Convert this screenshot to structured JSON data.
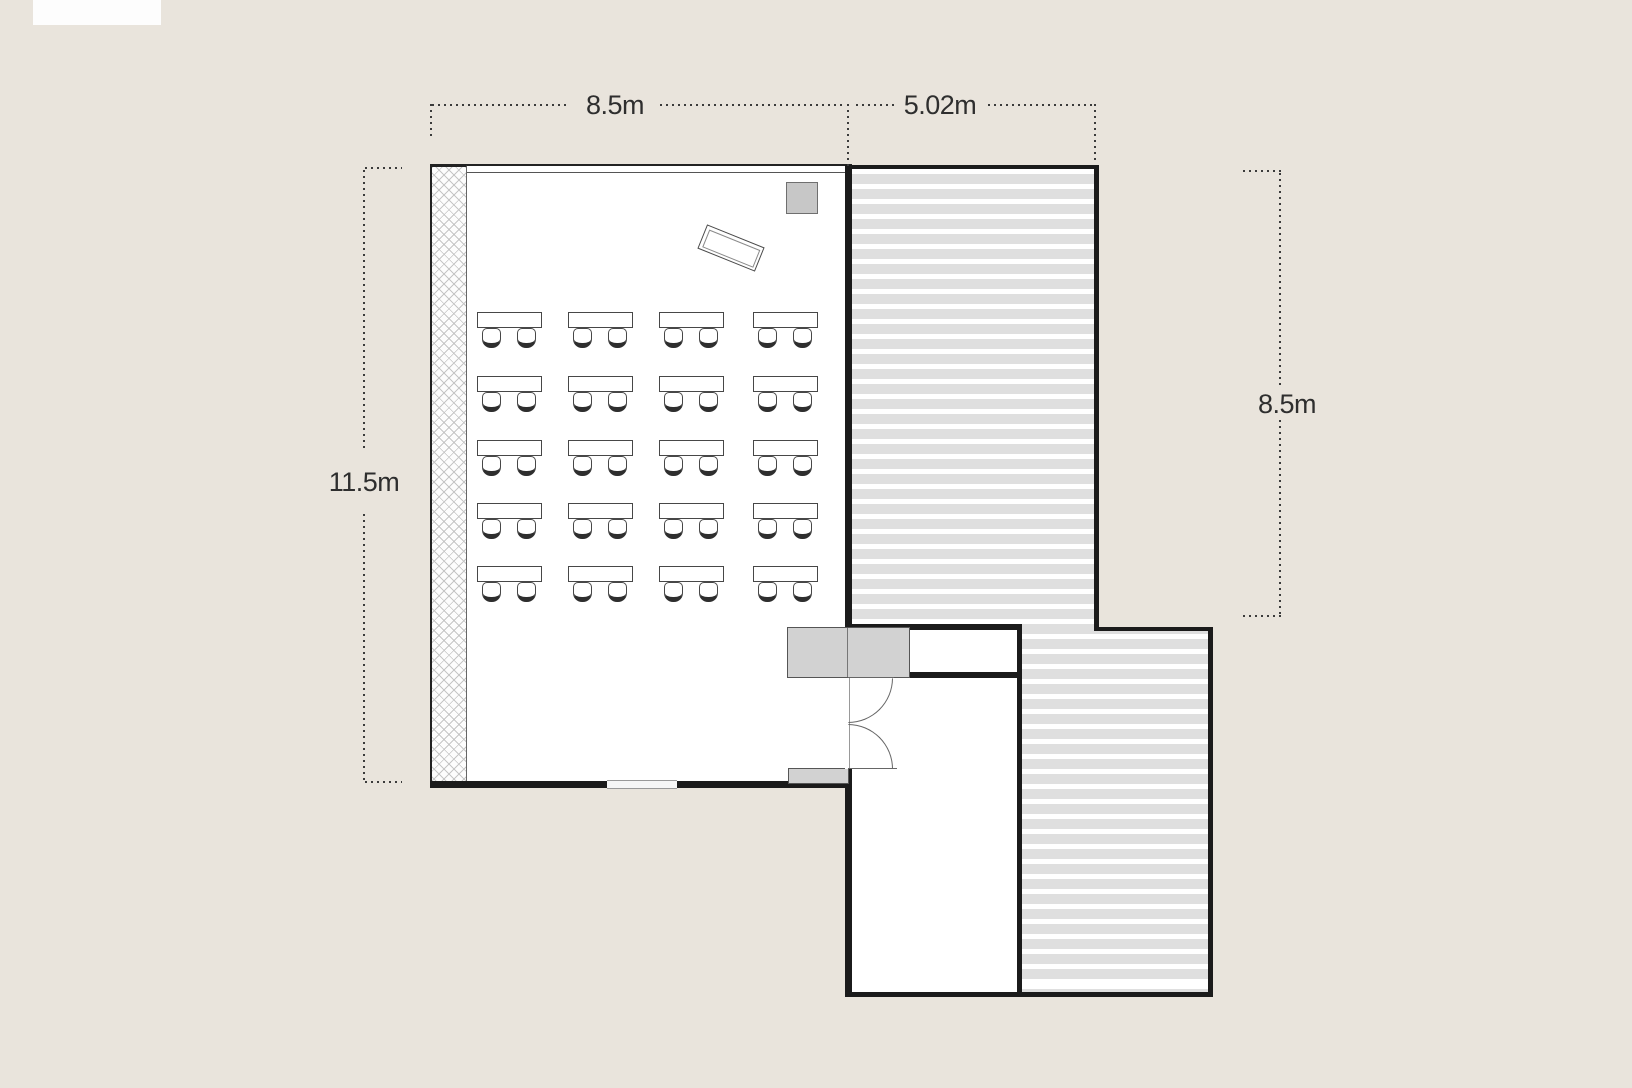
{
  "dimensions": {
    "top_width_main": "8.5m",
    "top_width_terrace": "5.02m",
    "left_height": "11.5m",
    "right_height": "8.5m"
  },
  "colors": {
    "canvas_background": "#e9e4dc",
    "wall": "#1b1b1b",
    "stripe_gray": "#dfdfdf",
    "fixture_gray": "#d2d2d2",
    "board_gray": "#c7c7c7",
    "furniture_outline": "#474747",
    "dimension_text": "#2e2e2e"
  },
  "floor_plan": {
    "classroom": {
      "seats_per_desk": 2,
      "desk_grid": {
        "rows": 5,
        "cols": 4,
        "row_tops": [
          312,
          376,
          440,
          503,
          566
        ],
        "col_lefts": [
          477,
          568,
          659,
          753
        ],
        "desk_w": 65,
        "desk_h": 16,
        "chair_w": 19,
        "chair_h": 20,
        "chair_offsets_x": [
          5,
          40
        ],
        "chair_offset_y": 16
      }
    }
  }
}
